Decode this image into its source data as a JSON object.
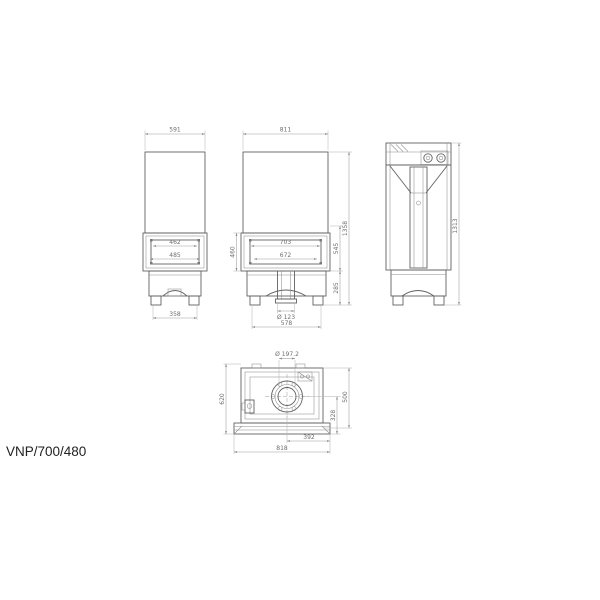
{
  "model_label": "VNP/700/480",
  "drawing": "Fireplace insert technical dimension drawing, four orthographic views",
  "views": {
    "side_left": {
      "name": "left side view",
      "dims": {
        "depth_top": "591",
        "side_glass_width": "462",
        "side_glass_opening_width": "485",
        "base_feet_span": "358"
      }
    },
    "front": {
      "name": "front view",
      "dims": {
        "width_top": "811",
        "opening_width": "703",
        "glass_width": "672",
        "glass_height": "460",
        "door_section_height": "545",
        "base_height": "285",
        "total_height": "1358",
        "air_inlet_diameter": "Ø 123",
        "base_width": "578"
      }
    },
    "side_right": {
      "name": "right side / back view",
      "dims": {
        "body_height": "1313"
      }
    },
    "top": {
      "name": "top view",
      "dims": {
        "flue_diameter": "Ø 197.2",
        "depth_total": "620",
        "depth_body": "500",
        "flue_center_to_front": "328",
        "flue_center_to_side": "392",
        "width_total": "818"
      }
    }
  },
  "colors": {
    "background": "#ffffff",
    "drawing_line": "#616161",
    "dimension_line": "#9c9c9c",
    "dimension_text": "#6e6e6e",
    "label_text": "#222222"
  }
}
